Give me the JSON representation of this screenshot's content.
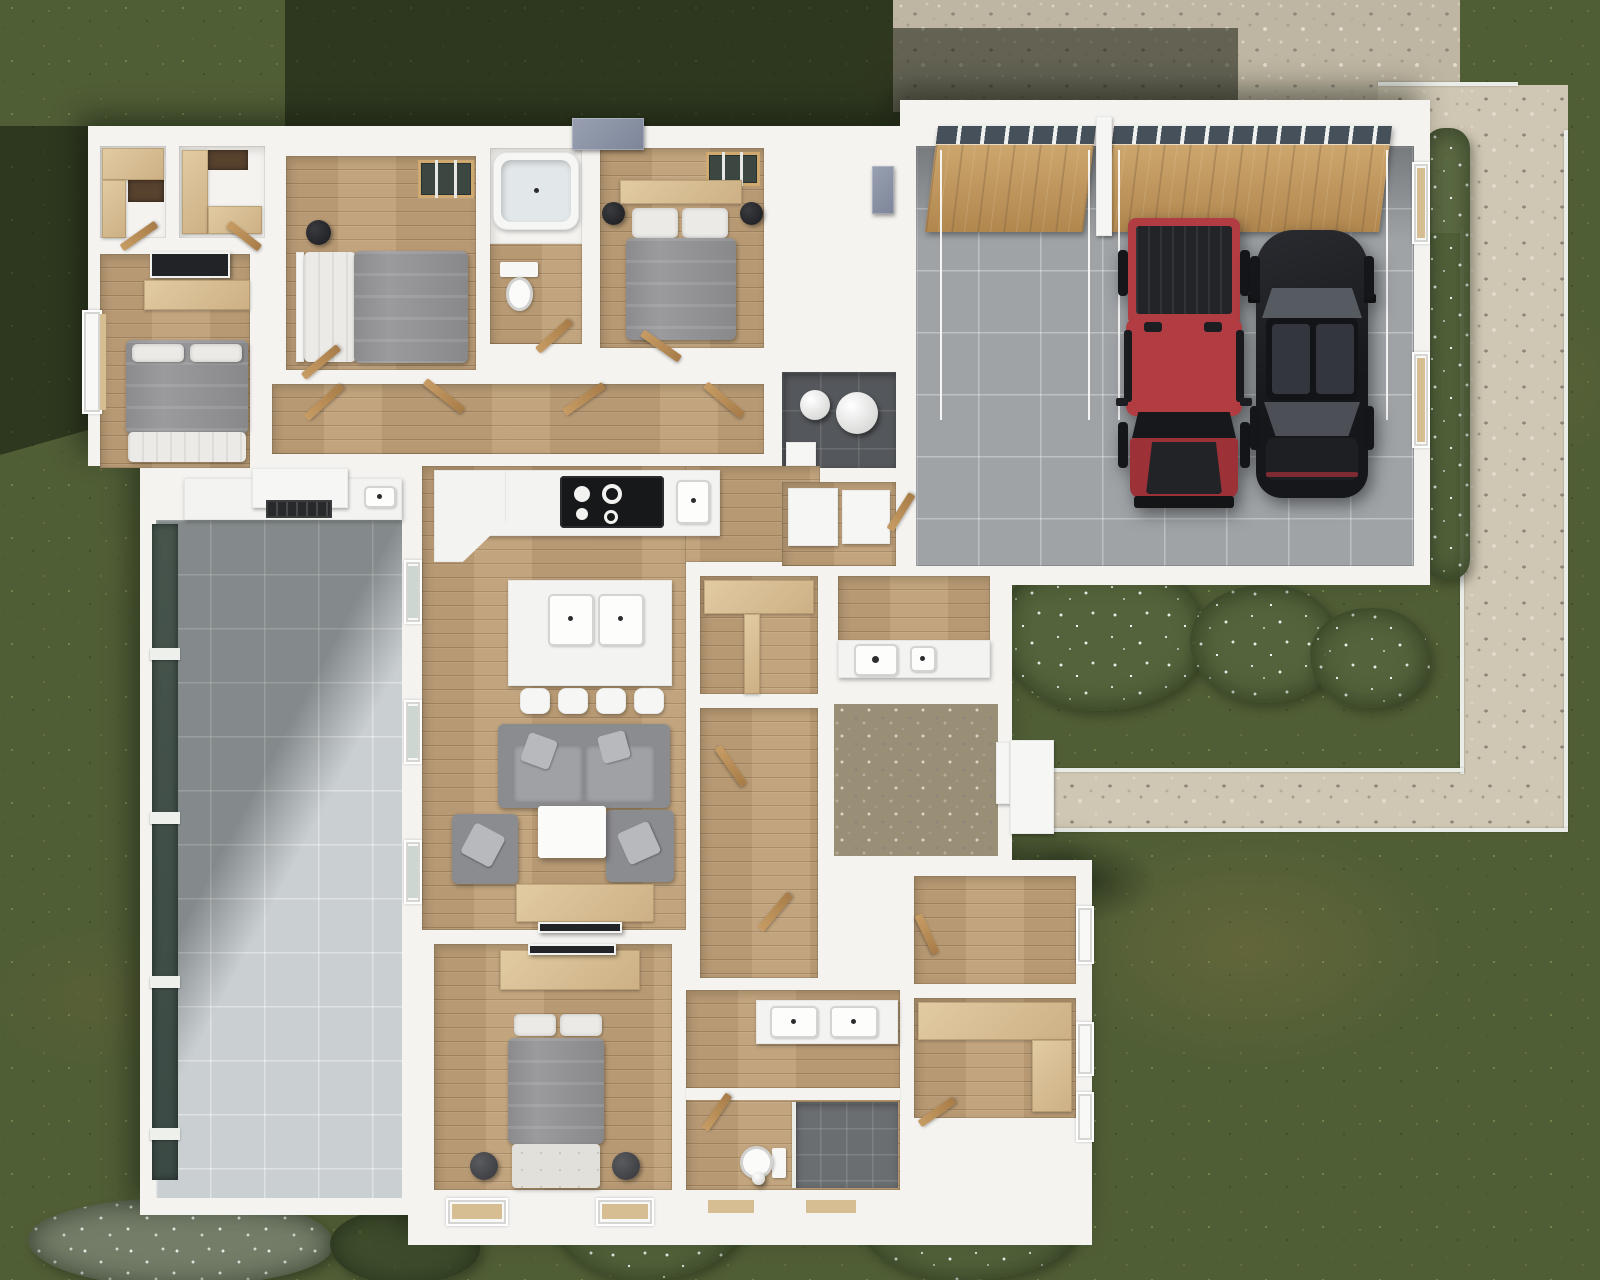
{
  "scene": {
    "description": "Aerial top-down 3D rendering of a single-story house floor plan with furnished rooms, attached two-car garage, covered patio, pebble driveway, stone walkway and lawn",
    "view": "top-down-3d-render",
    "palette": {
      "wall": "#f4f3f0",
      "wood_floor": "#bfa27c",
      "garage_floor": "#9fa3a6",
      "patio_tile": "#b6bcc1",
      "driveway": "#beb6a2",
      "walkway": "#cfc7b3",
      "foyer_pebble": "#998f77",
      "lawn": "#505e36",
      "shadow": "rgba(16,22,12,0.52)",
      "bedding_gray": "#9b9b9e",
      "sofa_gray": "#8b8c90",
      "counter_beige": "#d9c094",
      "door_wood": "#b5854f",
      "utility_floor": "#54575b",
      "shower_tile": "#6b6e71",
      "glass_dark": "#46544c"
    },
    "garage": {
      "floor": "gray-tile",
      "doors": [
        {
          "type": "single-overhead-wood-door",
          "window_strip": true
        },
        {
          "type": "double-overhead-wood-door",
          "window_strip": true
        }
      ],
      "vehicles": [
        {
          "type": "pickup-truck",
          "color": "#b13c42"
        },
        {
          "type": "sports-sedan",
          "color": "#1b1c20"
        }
      ]
    },
    "rooms": [
      {
        "id": "walk-in-closet-1",
        "floor": "white",
        "furniture": [
          "l-shaped-wood-shelving"
        ]
      },
      {
        "id": "walk-in-closet-2",
        "floor": "white",
        "furniture": [
          "l-shaped-wood-shelving"
        ]
      },
      {
        "id": "bedroom-1",
        "floor": "wood",
        "furniture": [
          "double-bed-gray",
          "dresser",
          "wall-tv",
          "window"
        ]
      },
      {
        "id": "bedroom-2",
        "floor": "wood",
        "furniture": [
          "double-bed-gray",
          "black-stool",
          "skylight"
        ]
      },
      {
        "id": "bathroom-1",
        "floor": "wood",
        "furniture": [
          "bathtub",
          "toilet"
        ]
      },
      {
        "id": "bedroom-3",
        "floor": "wood",
        "furniture": [
          "double-bed-gray",
          "two-black-stools",
          "headboard-shelf",
          "skylight"
        ]
      },
      {
        "id": "utility-room",
        "floor": "dark-tile",
        "furniture": [
          "water-heater",
          "softener-tank"
        ]
      },
      {
        "id": "kitchen",
        "floor": "wood",
        "furniture": [
          "counter-run",
          "cooktop",
          "island-with-double-sink",
          "four-bar-stools",
          "fridge-units"
        ]
      },
      {
        "id": "living-room",
        "floor": "wood",
        "furniture": [
          "sofa",
          "two-armchairs",
          "coffee-table",
          "media-console-tv"
        ]
      },
      {
        "id": "pantry",
        "floor": "wood",
        "furniture": [
          "wood-shelving"
        ]
      },
      {
        "id": "laundry",
        "floor": "wood",
        "furniture": [
          "washer",
          "utility-sink"
        ]
      },
      {
        "id": "entry-foyer",
        "floor": "pebble-stone",
        "furniture": [
          "front-door",
          "porch"
        ]
      },
      {
        "id": "hallway",
        "floor": "wood",
        "furniture": [
          "open-doors"
        ]
      },
      {
        "id": "office",
        "floor": "wood",
        "furniture": [
          "window"
        ]
      },
      {
        "id": "master-closet",
        "floor": "wood",
        "furniture": [
          "l-shaped-counter",
          "windows"
        ]
      },
      {
        "id": "master-bathroom",
        "floor": "wood",
        "furniture": [
          "double-vanity",
          "water-closet-toilet",
          "walk-in-shower"
        ]
      },
      {
        "id": "master-bedroom",
        "floor": "wood",
        "furniture": [
          "double-bed-gray",
          "foot-bench",
          "two-poufs",
          "media-console-tv",
          "two-windows"
        ]
      },
      {
        "id": "covered-patio",
        "floor": "gray-tile",
        "furniture": [
          "outdoor-kitchen-counter",
          "grill",
          "outdoor-sink",
          "glass-wall"
        ]
      }
    ],
    "exterior": {
      "driveway": "pebble-concrete with cast building shadow",
      "walkway": "light stone path with white curbs wrapping the garage",
      "shrubs": [
        "white-flowering-bushes",
        "silver-bushes"
      ],
      "lawn": "textured grass with dry patches"
    }
  }
}
